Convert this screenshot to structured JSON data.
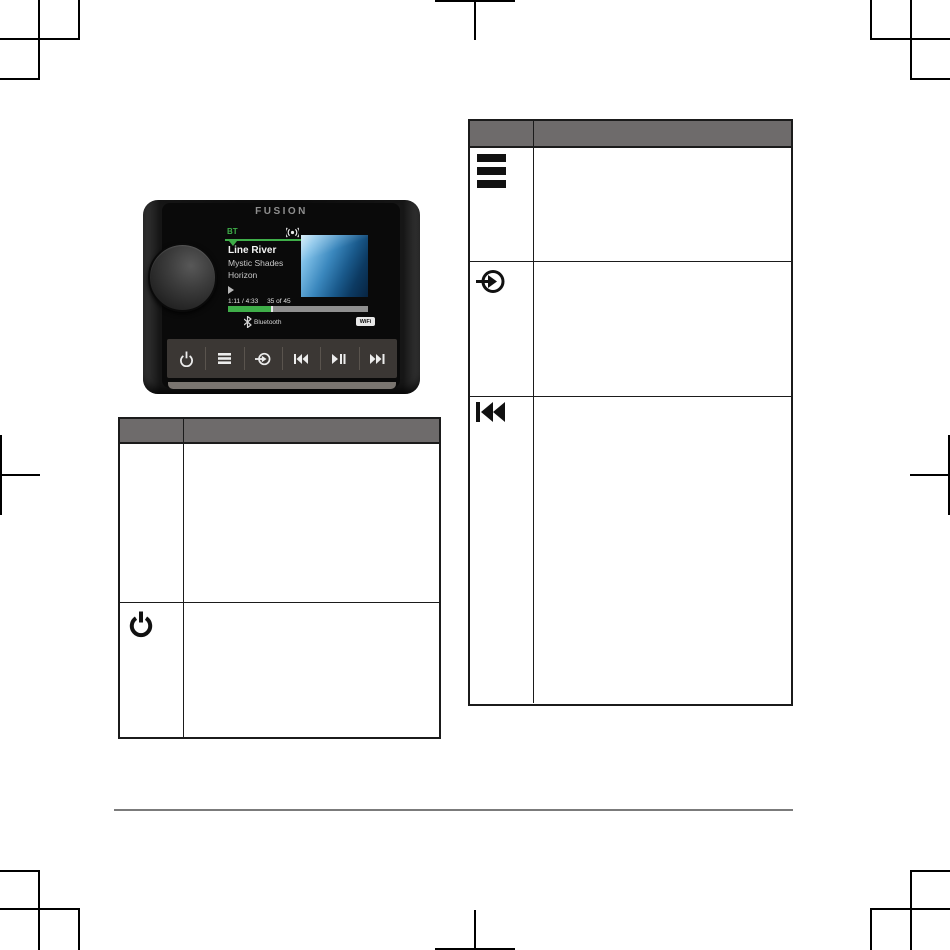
{
  "page": {
    "type": "printed-manual-page",
    "crop_mark_color": "#000000",
    "footer_rule_color": "#7b7b7b"
  },
  "device": {
    "brand_logo": "FUSION",
    "dial_icon": "rotary-knob",
    "screen": {
      "source_label": "BT",
      "track_title": "Line River",
      "track_artist": "Mystic Shades",
      "track_album": "Horizon",
      "time_display": "1:11 / 4:33",
      "track_position": "35 of 45",
      "progress_percent": 31,
      "accent_green": "#3fae49",
      "bluetooth_label": "Bluetooth",
      "wifi_label": "WiFi"
    },
    "buttons": [
      {
        "icon": "power-icon"
      },
      {
        "icon": "menu-icon"
      },
      {
        "icon": "source-icon"
      },
      {
        "icon": "skip-back-icon"
      },
      {
        "icon": "play-pause-icon"
      },
      {
        "icon": "skip-forward-icon"
      }
    ]
  },
  "left_table": {
    "style": {
      "header_bg": "#6e6b6b",
      "border_color": "#1b1b1b"
    },
    "header": {
      "col_icon": "",
      "col_description": ""
    },
    "rows": [
      {
        "icon": "",
        "description": ""
      },
      {
        "icon": "power-icon",
        "description": ""
      }
    ]
  },
  "right_table": {
    "style": {
      "header_bg": "#6e6b6b",
      "border_color": "#1b1b1b"
    },
    "header": {
      "col_icon": "",
      "col_description": ""
    },
    "rows": [
      {
        "icon": "menu-icon",
        "description": ""
      },
      {
        "icon": "source-icon",
        "description": ""
      },
      {
        "icon": "skip-back-icon",
        "description": ""
      }
    ]
  }
}
